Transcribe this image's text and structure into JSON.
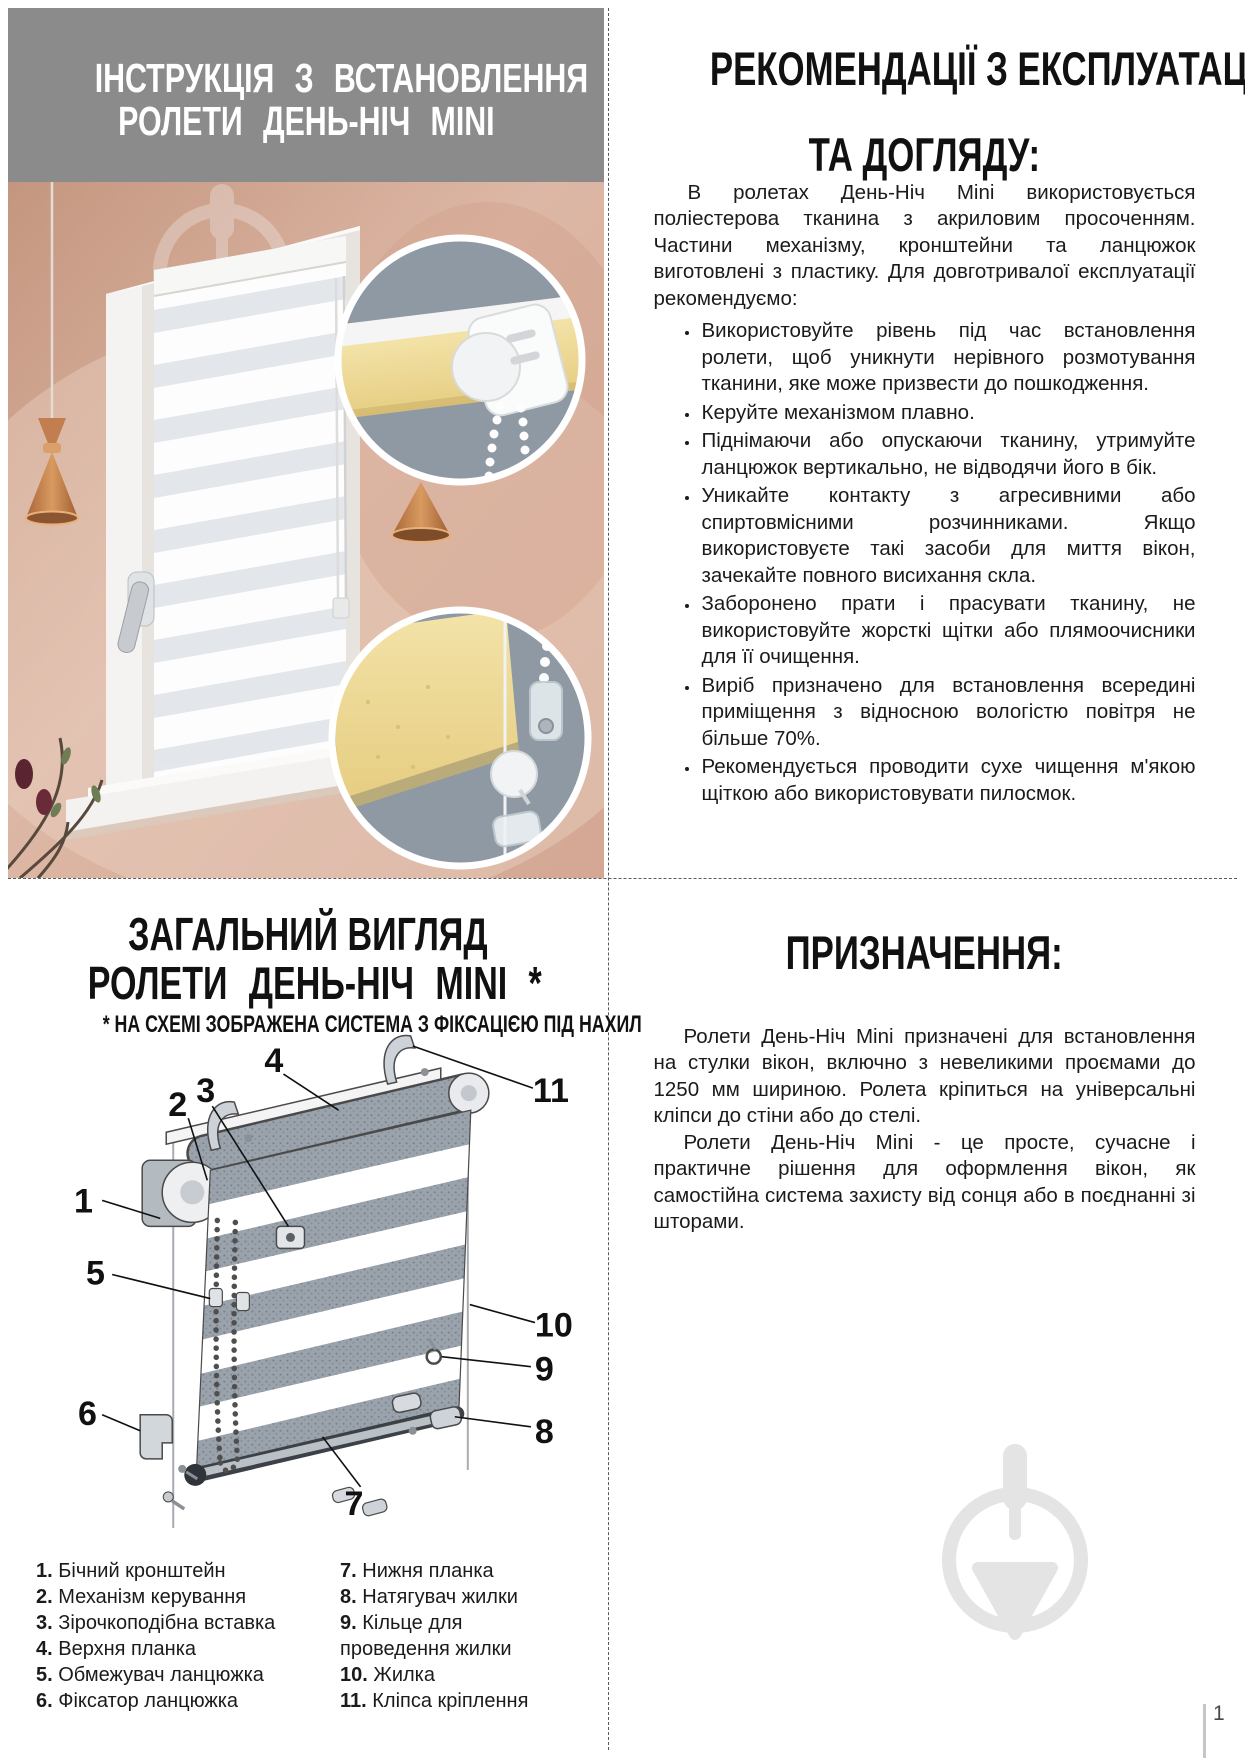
{
  "page": {
    "number": "1"
  },
  "install": {
    "title_line1": "ІНСТРУКЦІЯ З ВСТАНОВЛЕННЯ",
    "title_line2": "РОЛЕТИ ДЕНЬ-НІЧ MINI"
  },
  "care": {
    "title_line1": "РЕКОМЕНДАЦІЇ З ЕКСПЛУАТАЦІЇ",
    "title_line2": "ТА ДОГЛЯДУ:",
    "intro": "В ролетах День-Ніч Mini використовується поліестерова тканина з акриловим просоченням. Частини механізму, кронштейни та ланцюжок виготовлені з пластику. Для довготривалої експлуатації рекомендуємо:",
    "bullets": [
      "Використовуйте рівень під час встановлення ролети, щоб уникнути нерівного розмотування тканини, яке може призвести до пошкодження.",
      "Керуйте механізмом плавно.",
      "Піднімаючи або опускаючи тканину, утримуйте ланцюжок вертикально, не відводячи його в бік.",
      "Уникайте контакту з агресивними або спиртовмісними розчинниками. Якщо використовуєте такі засоби для миття вікон, зачекайте повного висихання скла.",
      "Заборонено прати і прасувати тканину, не використовуйте жорсткі щітки або плямоочисники для її очищення.",
      "Виріб призначено для встановлення всередині приміщення з відносною вологістю повітря не більше 70%.",
      "Рекомендується проводити сухе чищення м'якою щіткою або використовувати пилосмок."
    ]
  },
  "overview": {
    "title_line1": "ЗАГАЛЬНИЙ ВИГЛЯД",
    "title_line2": "РОЛЕТИ ДЕНЬ-НІЧ MINI *",
    "subtitle": "* НА СХЕМІ ЗОБРАЖЕНА СИСТЕМА З ФІКСАЦІЄЮ ПІД НАХИЛ",
    "callouts": [
      "1",
      "2",
      "3",
      "4",
      "5",
      "6",
      "7",
      "8",
      "9",
      "10",
      "11"
    ],
    "legend_left": [
      {
        "num": "1.",
        "label": "Бічний кронштейн"
      },
      {
        "num": "2.",
        "label": "Механізм керування"
      },
      {
        "num": "3.",
        "label": "Зірочкоподібна вставка"
      },
      {
        "num": "4.",
        "label": "Верхня планка"
      },
      {
        "num": "5.",
        "label": "Обмежувач ланцюжка"
      },
      {
        "num": "6.",
        "label": "Фіксатор ланцюжка"
      }
    ],
    "legend_right": [
      {
        "num": "7.",
        "label": "Нижня планка"
      },
      {
        "num": "8.",
        "label": "Натягувач жилки"
      },
      {
        "num": "9.",
        "label": "Кільце для\nпроведення жилки"
      },
      {
        "num": "10.",
        "label": "Жилка"
      },
      {
        "num": "11.",
        "label": "Кліпса кріплення"
      }
    ]
  },
  "purpose": {
    "title": "ПРИЗНАЧЕННЯ:",
    "p1": "Ролети День-Ніч Mini призначені для встановлення на стулки вікон, включно з невеликими проємами до 1250 мм шириною. Ролета кріпиться на універсальні кліпси до стіни або до стелі.",
    "p2": "Ролети День-Ніч Mini - це просте, сучасне і практичне рішення для оформлення вікон, як самостійна система захисту від сонця або в поєднанні зі шторами."
  },
  "colors": {
    "header_band": "#8b8b8b",
    "wall_pink": "#d6ab99",
    "inset_slate": "#8e99a3",
    "fabric_yellow": "#efdc9c",
    "lamp_copper": "#c07c4a",
    "watermark_gray": "#e4e4e4"
  }
}
